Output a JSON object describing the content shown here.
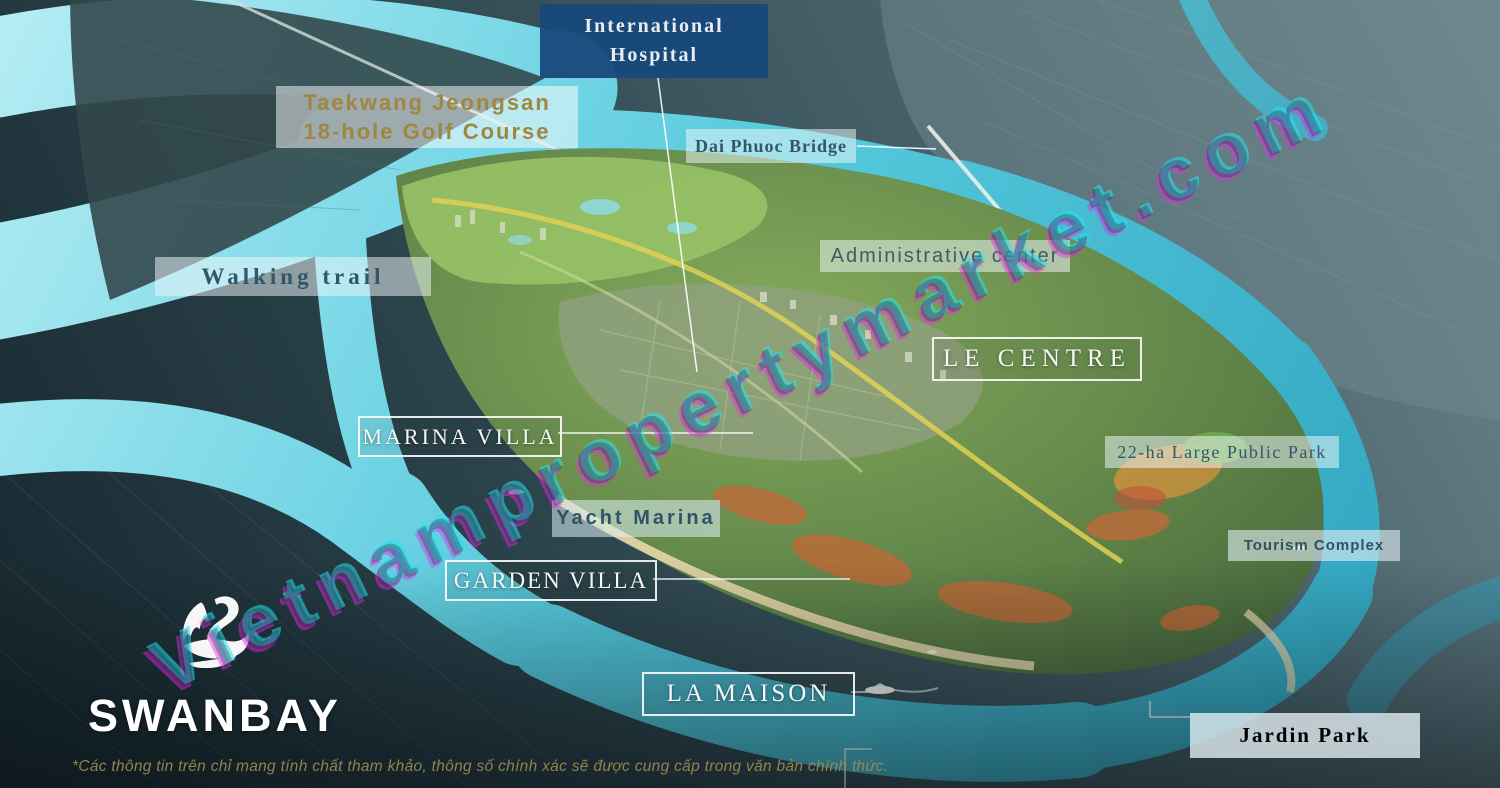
{
  "watermark": {
    "text": "Vietnampropertymarket.com"
  },
  "logo": {
    "text": "SWANBAY"
  },
  "labels": {
    "international_hospital": {
      "line1": "International",
      "line2": "Hospital"
    },
    "golf_course": {
      "line1": "Taekwang Jeongsan",
      "line2": "18-hole Golf Course"
    },
    "dai_phuoc_bridge": {
      "text": "Dai Phuoc Bridge"
    },
    "walking_trail": {
      "text": "Walking trail"
    },
    "administrative_center": {
      "text": "Administrative center"
    },
    "le_centre": {
      "text": "LE CENTRE"
    },
    "marina_villa": {
      "text": "MARINA VILLA"
    },
    "public_park": {
      "text": "22-ha Large Public Park"
    },
    "yacht_marina": {
      "text": "Yacht Marina"
    },
    "garden_villa": {
      "text": "GARDEN VILLA"
    },
    "tourism_complex": {
      "text": "Tourism Complex"
    },
    "la_maison": {
      "text": "LA MAISON"
    },
    "jardin_park": {
      "text": "Jardin Park"
    }
  },
  "disclaimer": {
    "text": "*Các thông tin trên chỉ mang tính chất tham khảo, thông số chính xác sẽ được cung cấp trong văn bản chính thức."
  },
  "colors": {
    "hospital_box": "#17497A",
    "gold_label_text": "#A0873F",
    "slate_label_text": "#33566B",
    "river_cyan": "#55CADD",
    "island_green": "#5D8147",
    "label_outline_white": "#FFFFFF"
  }
}
